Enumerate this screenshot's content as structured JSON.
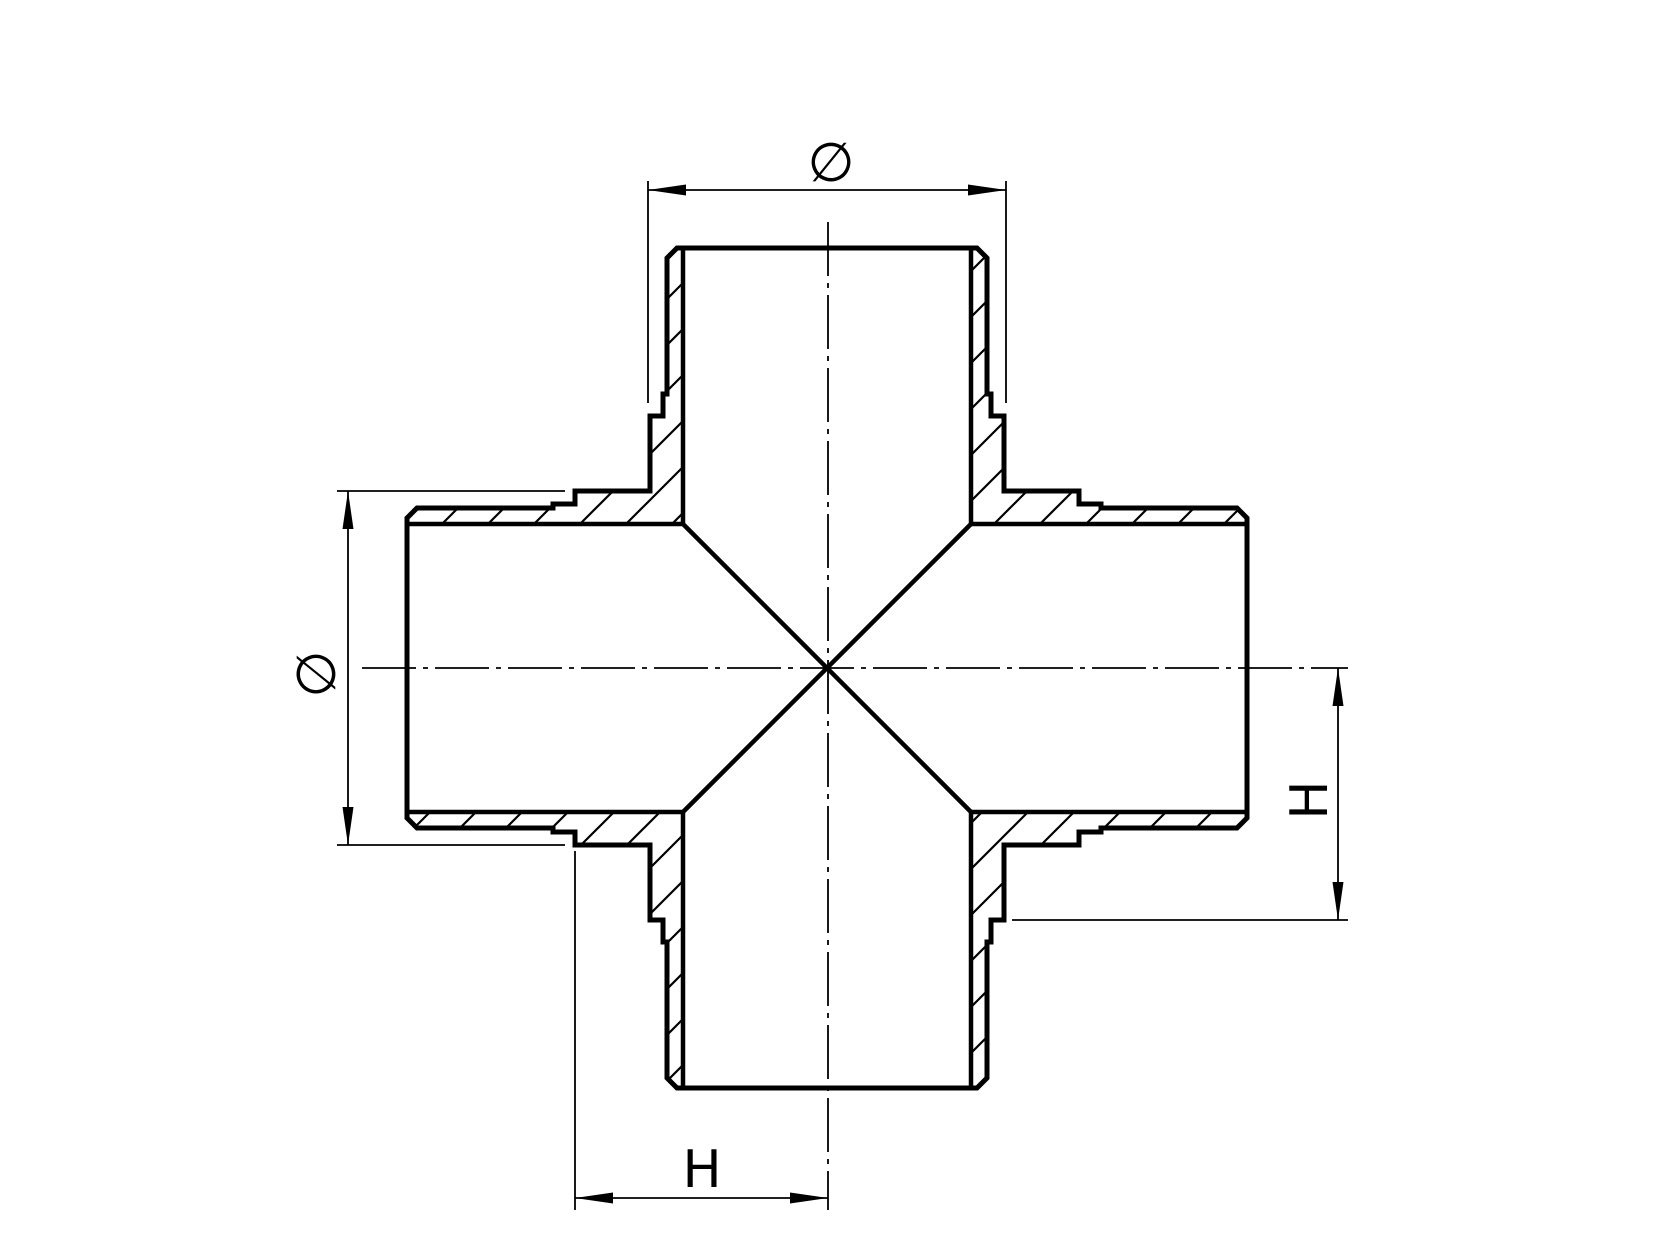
{
  "page": {
    "background": "#ffffff",
    "line_color": "#000000"
  },
  "drawing": {
    "view": "sectioned equal cross pipe fitting, four identical male ends with shoulders",
    "labels": {
      "top_diameter": "∅",
      "left_diameter": "∅",
      "right_height": "H",
      "bottom_height": "H"
    }
  }
}
